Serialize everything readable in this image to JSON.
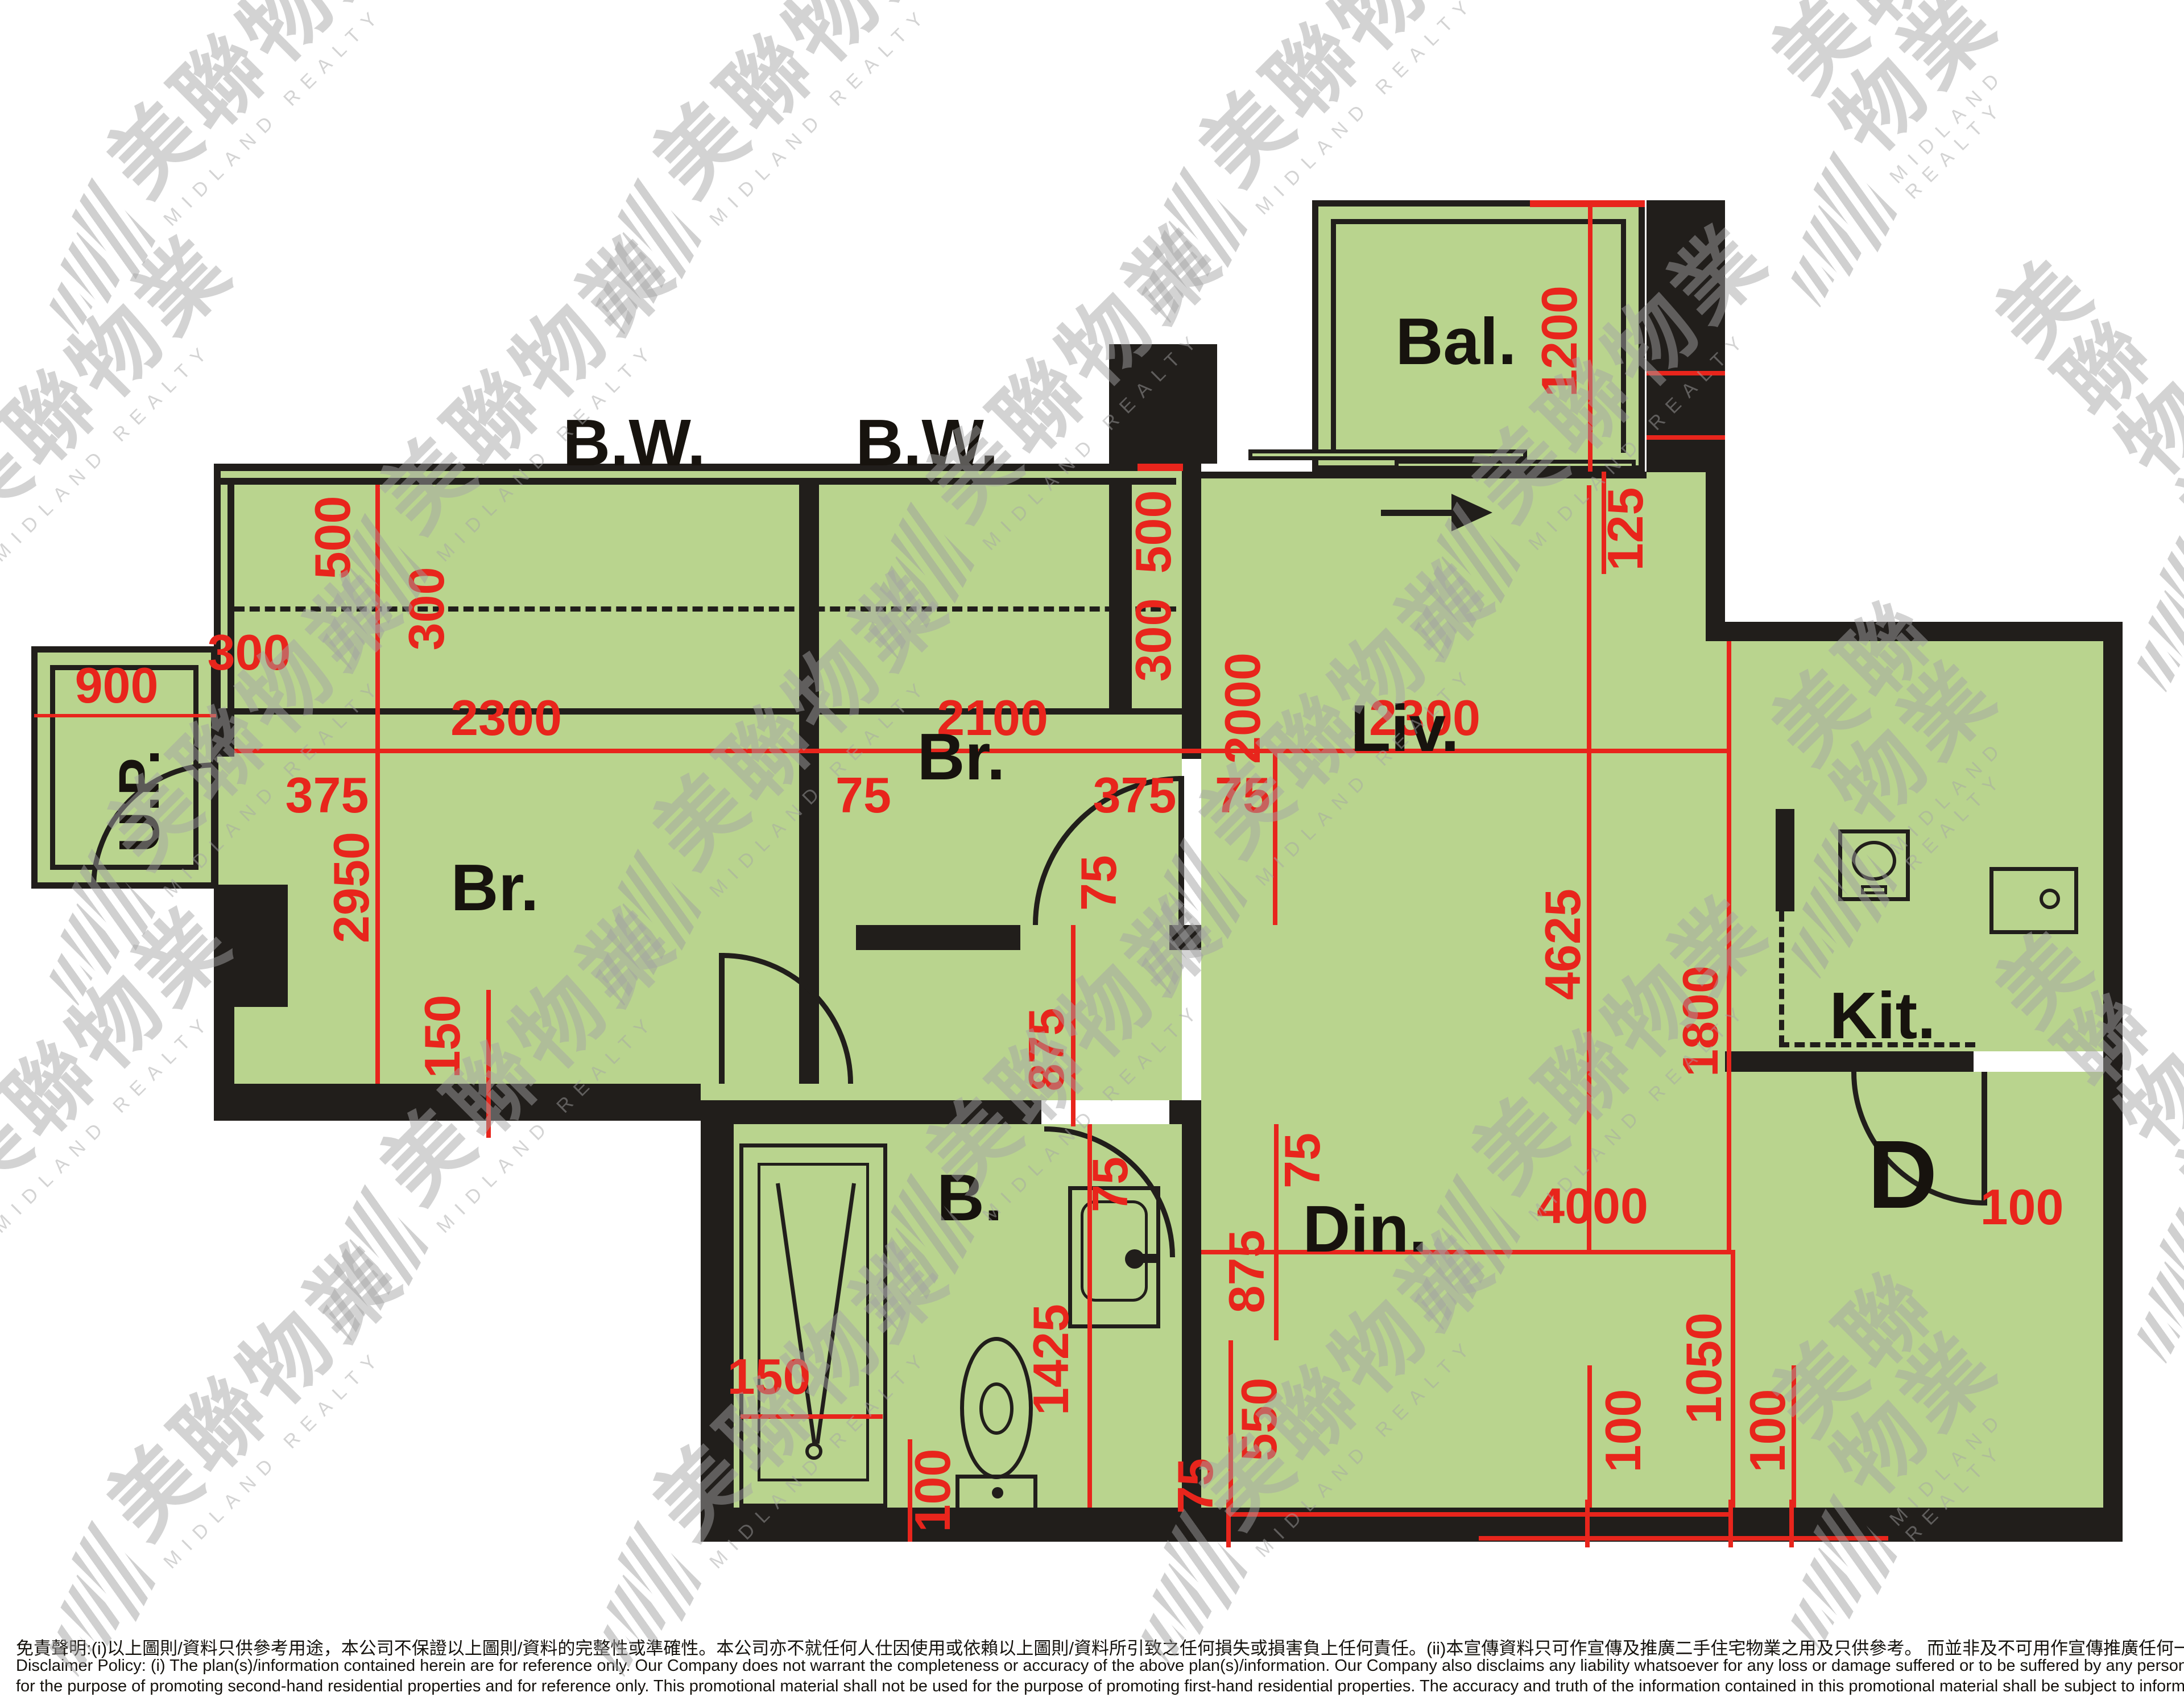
{
  "colors": {
    "floor_fill": "#b9d48e",
    "wall": "#211e1b",
    "dimension_red": "#e8251c",
    "watermark_gray": "#a5a5a5",
    "background": "#ffffff"
  },
  "watermark": {
    "zh": "美聯物業",
    "en": "MIDLAND REALTY"
  },
  "rooms": {
    "bw1": "B.W.",
    "bw2": "B.W.",
    "br1": "Br.",
    "br2": "Br.",
    "liv": "Liv.",
    "bal": "Bal.",
    "din": "Din.",
    "kit": "Kit.",
    "bath": "B.",
    "up": "U.P.",
    "entrance_door": "D"
  },
  "dims": {
    "bw_depth_left": "500",
    "bw_inner_left": "300",
    "edge_left": "300",
    "br1_width": "2300",
    "br2_width": "2100",
    "wall_left": "375",
    "partition": "75",
    "wall_right": "375",
    "liv_width": "2300",
    "liv_wall": "75",
    "up_width": "900",
    "br1_depth": "2950",
    "br2_depth": "2000",
    "bw_depth_right": "500",
    "bw_inner_right": "300",
    "bal_depth": "1200",
    "bal_edge": "125",
    "livdin_depth": "4625",
    "kit_depth": "1800",
    "din_width": "4000",
    "corridor_wall": "75",
    "corridor": "875",
    "din_wall": "75",
    "din_inset": "875",
    "bath_length": "1425",
    "bath_clear": "100",
    "basin_width": "75",
    "bath_wall": "75",
    "din_bottom": "550",
    "ent_clear_a": "100",
    "ent_width": "1050",
    "ent_clear_b": "100",
    "shower_width": "150",
    "wall_thick": "150",
    "door_width": "100"
  },
  "disclaimer": {
    "zh": "免責聲明:(i)以上圖則/資料只供參考用途，本公司不保證以上圖則/資料的完整性或準確性。本公司亦不就任何人仕因使用或依賴以上圖則/資料所引致之任何損失或損害負上任何責任。(ii)本宣傳資料只可作宣傳及推廣二手住宅物業之用及只供參考。 而並非及不可用作宣傳推廣任何一手住宅物業。其準確性及真實性以樓盤發展商提供的資料為準。",
    "en1": "Disclaimer Policy: (i) The plan(s)/information contained herein are for reference only. Our Company does not warrant the completeness or accuracy of the above plan(s)/information. Our Company also disclaims any liability whatsoever for any loss or damage suffered or to be suffered by any person as a result of using or relying on the plan(s)/information. (ii) This promotional material is",
    "en2": "for the purpose of promoting second-hand residential properties and for reference only. This promotional material shall not be used for the purpose of promoting first-hand residential properties. The accuracy and truth of the information contained in this promotional material shall be subject to information provided by the developers."
  }
}
